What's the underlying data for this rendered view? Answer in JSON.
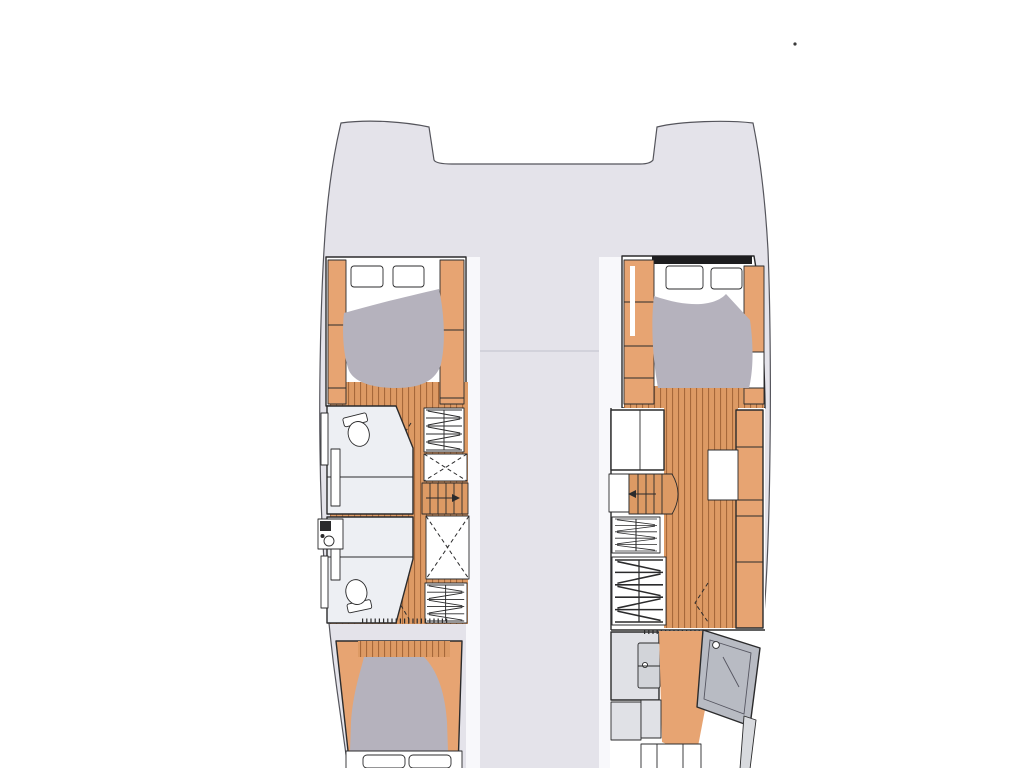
{
  "diagram": {
    "kind": "catamaran-deck-plan",
    "visible_text": []
  },
  "colors": {
    "background": "#ffffff",
    "deck": "#e4e3ea",
    "hull_outline": "#55555c",
    "inner_margin": "#f8f8fb",
    "coachroof_line": "#ccccd6",
    "wood_floor": "#dd9a64",
    "wood_plank_line": "#a6683a",
    "furniture_wood": "#e7a472",
    "mattress": "#b5b2bd",
    "bathroom_floor": "#edeff3",
    "cabinet_gray": "#e0e1e6",
    "fixture_gray": "#d2d4d9",
    "shower_frame": "#b8bbc3",
    "shower_glass": "#d0d3d9",
    "bulkhead_black": "#1d1d1f",
    "transom_step_gray": "#d8dade",
    "stray_mark": "#3a3a3a"
  },
  "symbols": {
    "hanger-symbol": "zigzag-rows (hanging wardrobe)",
    "locker-symbol": "dashed-X box (hanging locker)",
    "stairs-symbol": "treads with direction arrow",
    "toilet-symbol": "oval bowl with tank",
    "door-swing-symbol": "dashed chevron",
    "shower-symbol": "tilted glass pane with drain dot",
    "bed-symbol": "gray mattress with pillows",
    "window-symbol": "rounded rectangle pane"
  }
}
